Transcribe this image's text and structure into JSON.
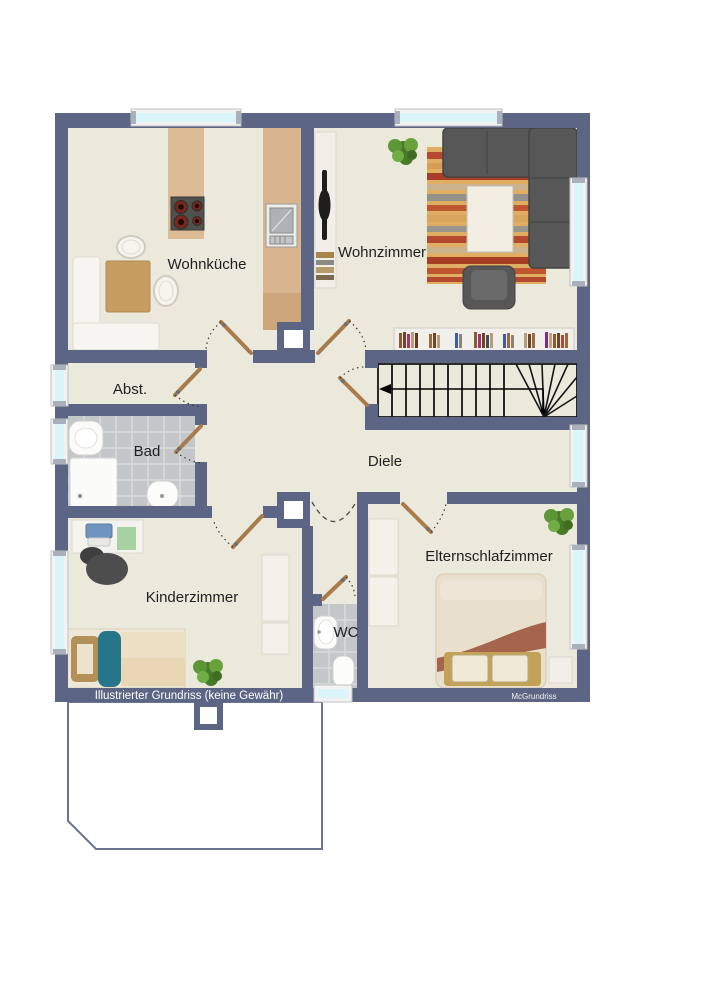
{
  "rooms": {
    "wohnkueche": {
      "label": "Wohnküche"
    },
    "wohnzimmer": {
      "label": "Wohnzimmer"
    },
    "abstellraum": {
      "label": "Abst."
    },
    "bad": {
      "label": "Bad"
    },
    "diele": {
      "label": "Diele"
    },
    "kinderzimmer": {
      "label": "Kinderzimmer"
    },
    "wc": {
      "label": "WC"
    },
    "elternschlafzimmer": {
      "label": "Elternschlafzimmer"
    }
  },
  "footer": {
    "caption": "Illustrierter Grundriss (keine Gewähr)",
    "credit": "McGrundriss"
  },
  "colors": {
    "wall": "#5c6684",
    "floor": "#ebe8dc",
    "tile": "#c4c7ca",
    "window_glass": "#daf5f9",
    "door_leaf": "#a87a4c",
    "label_text": "#1f1f1f",
    "footer_text": "#ffffff"
  }
}
